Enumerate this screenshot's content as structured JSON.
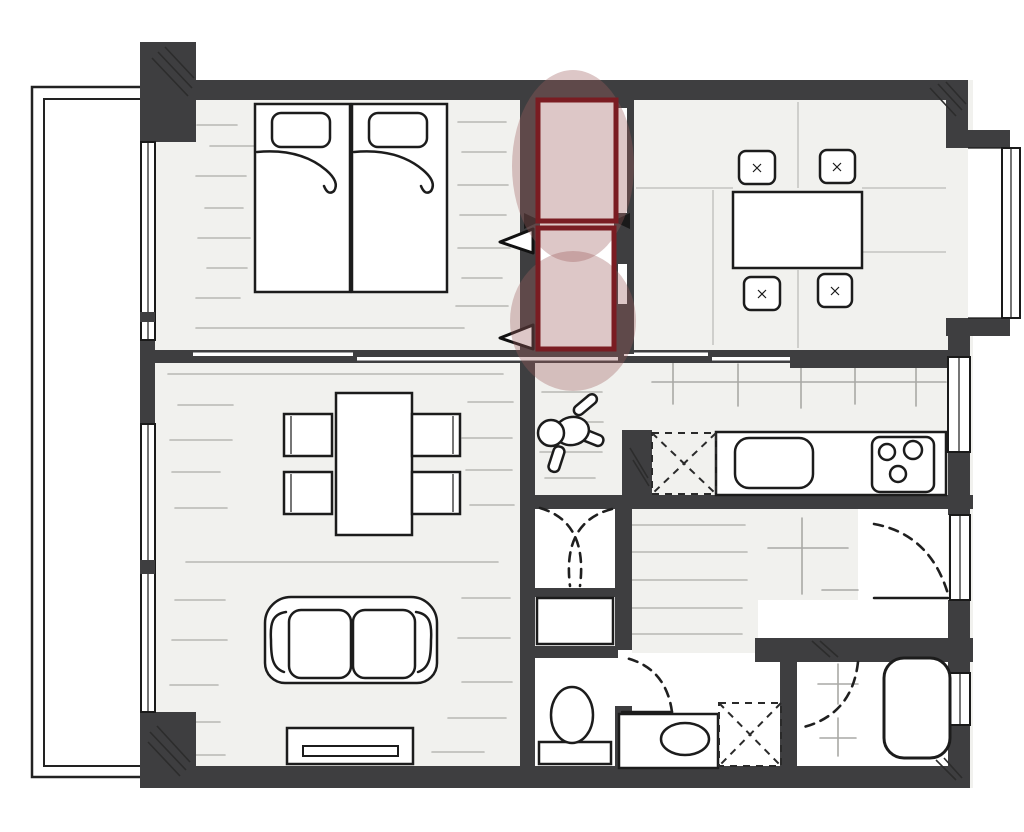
{
  "meta": {
    "title": "Apartment floor plan (hand-drawn style, top-down view)",
    "type": "architectural-floor-plan",
    "visible_text": "none"
  },
  "palette": {
    "wall": "#3e3e40",
    "ink": "#1c1c1c",
    "floor": "#f1f1ee",
    "floorline": "#b7b7b3",
    "tileline": "#a9a9a5",
    "seam": "#c4c4c0",
    "hl": "#9d5f5f",
    "hlstroke": "#7a1c22",
    "paper": "#ffffff"
  },
  "highlight": {
    "kind": "attention-annotation",
    "style": "dark-red outlined rectangles with soft pink oval glow",
    "marked_item": "two stacked closet/storage units between bedroom and dining room",
    "rectangle_count": 2,
    "ellipse_count": 2
  },
  "rooms": [
    {
      "id": "balcony",
      "name": "Balcony",
      "furniture": []
    },
    {
      "id": "bedroom",
      "name": "Bedroom",
      "furniture": [
        "twin bed left with pillow",
        "twin bed right with pillow"
      ]
    },
    {
      "id": "closet",
      "name": "Closet (highlighted)",
      "furniture": [
        "upper closet unit",
        "lower closet unit",
        "folding-door arrows"
      ]
    },
    {
      "id": "dining",
      "name": "Dining room",
      "furniture": [
        "dining table",
        "chair x4 (cushions with stitch marks)"
      ]
    },
    {
      "id": "kitchen",
      "name": "Kitchen",
      "furniture": [
        "counter",
        "sink",
        "cooktop with 3 burners",
        "refrigerator space (dashed X)"
      ]
    },
    {
      "id": "living",
      "name": "Living room",
      "furniture": [
        "table",
        "chair x4",
        "two-seat sofa",
        "TV board"
      ]
    },
    {
      "id": "hallway",
      "name": "Hallway",
      "furniture": [
        "person figure (top view)"
      ]
    },
    {
      "id": "entry",
      "name": "Entry / genkan",
      "furniture": [
        "front door with swing arc",
        "tiled step"
      ]
    },
    {
      "id": "entry-closet",
      "name": "Hall storage",
      "furniture": [
        "bi-fold doors (dashed)"
      ]
    },
    {
      "id": "cabinet",
      "name": "Hall cabinet",
      "furniture": [
        "cabinet"
      ]
    },
    {
      "id": "toilet",
      "name": "Toilet room",
      "furniture": [
        "toilet with tank"
      ]
    },
    {
      "id": "washroom",
      "name": "Washroom",
      "furniture": [
        "vanity with oval sink",
        "washing machine space (dashed X)",
        "door with swing arc"
      ]
    },
    {
      "id": "bathroom",
      "name": "Bathroom",
      "furniture": [
        "bathtub",
        "wash place tiles",
        "door swing arc"
      ]
    }
  ]
}
